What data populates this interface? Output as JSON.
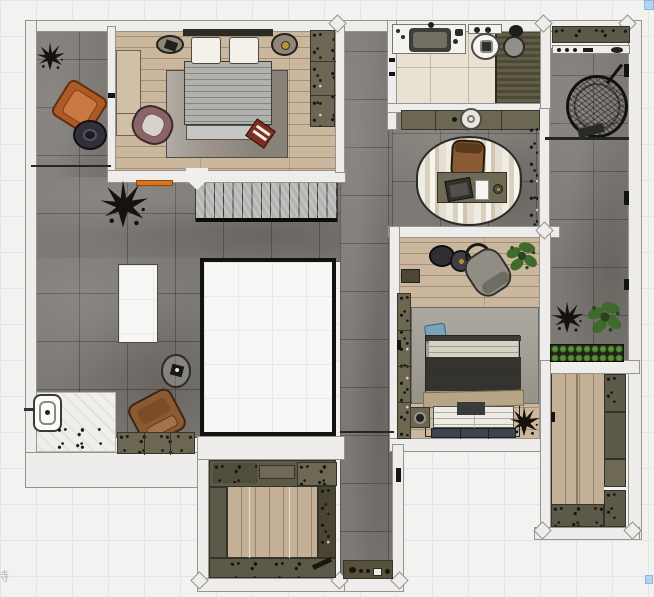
{
  "watermark": "持",
  "canvas": {
    "width": 654,
    "height": 597
  },
  "palette": {
    "wall": "#eeedeb",
    "wall_outline": "#96948f",
    "tile_floor": "#7d7974",
    "wood_floor": "#cbb79d",
    "wood_floor_2": "#c4b096",
    "bath_tile": "#e9e2d3",
    "shower_slats": "#57543f",
    "olive_cabinet": "#6b6753",
    "planter_dark": "#5d5948",
    "rug_grey": "#9c948a",
    "rug_grey_2": "#a39f96",
    "stair_tread": "#b5b5b3",
    "void_border": "#121210",
    "accent_orange": "#ad5a26",
    "accent_mauve": "#8b6467",
    "accent_brown": "#8a5a33",
    "duvet_dark": "#34332e",
    "blanket_beige": "#b6a586",
    "pillow_blue": "#7aa3b8",
    "plant_green": "#3f6a2c",
    "sketch_black": "#14130f",
    "red_tray": "#7e2f24",
    "door_mat_orange": "#d9731c",
    "selection_handle": "#b5d2ee"
  },
  "rooms": [
    {
      "id": "master-bedroom",
      "label": "master bedroom",
      "floor": "wood-plank",
      "objects": [
        "double-bed",
        "pillow",
        "pillow",
        "nightstand-left",
        "nightstand-right",
        "area-rug",
        "low-sideboard",
        "mauve-armchair",
        "red-tray",
        "wardrobe",
        "orange-door-mat",
        "door-leaf"
      ]
    },
    {
      "id": "bathroom",
      "label": "bathroom",
      "floor": "beige-tile",
      "objects": [
        "vanity-counter",
        "basin-sink",
        "toilet",
        "walk-in-shower",
        "shower-drain"
      ]
    },
    {
      "id": "hallway-console",
      "label": "hallway console",
      "objects": [
        "console-cabinet",
        "vase"
      ]
    },
    {
      "id": "study-landing",
      "label": "study landing",
      "floor": "grey-tile",
      "objects": [
        "oval-striped-rug",
        "desk",
        "laptop",
        "notepad",
        "bowl",
        "office-chair",
        "wall-vine-planter"
      ]
    },
    {
      "id": "bedroom-2",
      "label": "bedroom 2",
      "floor": "wood-plank",
      "objects": [
        "double-bed",
        "storage-bench",
        "blue-pillow",
        "area-rug",
        "nightstand",
        "lounge-chair",
        "round-side-table",
        "ring-side-table",
        "lamp-table",
        "potted-plant-green",
        "potted-plant-dark",
        "wardrobe",
        "wall-console"
      ]
    },
    {
      "id": "left-terrace",
      "label": "left terrace",
      "floor": "grey-tile",
      "objects": [
        "sketch-plant-small",
        "orange-armchair",
        "round-coffee-table",
        "sketch-plant-large",
        "skylight",
        "round-side-table",
        "brown-armchair",
        "outdoor-tub",
        "stone-strip",
        "planter-boxes",
        "scatter-debris"
      ]
    },
    {
      "id": "right-terrace",
      "label": "right terrace",
      "floor": "grey-tile",
      "objects": [
        "planter-band",
        "shelf-with-items",
        "hanging-egg-chair",
        "potted-plant-dark",
        "potted-plant-green",
        "hedge-planter"
      ]
    },
    {
      "id": "stairwell",
      "label": "staircase",
      "objects": [
        "stair-treads",
        "stringer"
      ]
    },
    {
      "id": "void-opening",
      "label": "open void"
    },
    {
      "id": "courtyard-garden",
      "label": "courtyard garden",
      "floor": "wood-deck",
      "objects": [
        "planter-border",
        "deck-floor",
        "garden-tool"
      ]
    },
    {
      "id": "garden-room",
      "label": "garden room",
      "floor": "wood-deck",
      "objects": [
        "planter-border",
        "deck-floor"
      ]
    },
    {
      "id": "corridor",
      "label": "garden corridor",
      "floor": "grey-tile",
      "objects": [
        "garden-shelf",
        "small-tools"
      ]
    }
  ]
}
